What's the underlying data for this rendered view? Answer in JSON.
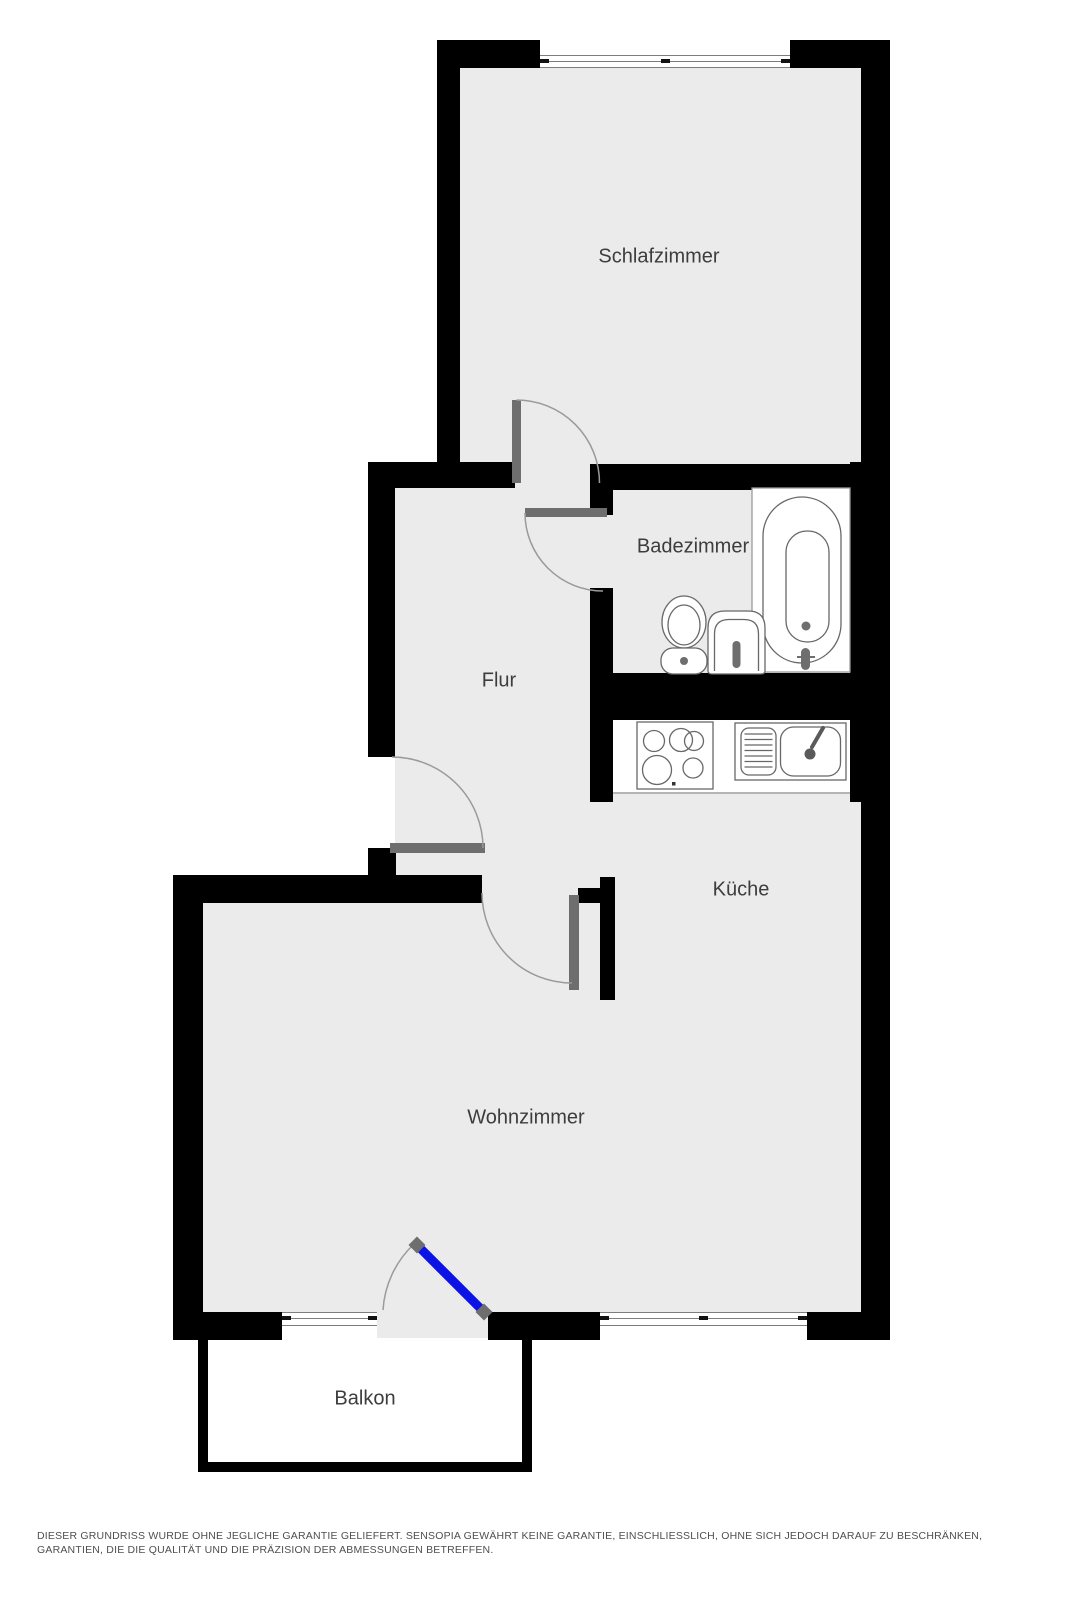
{
  "floorplan": {
    "rooms": [
      {
        "id": "schlafzimmer",
        "label": "Schlafzimmer"
      },
      {
        "id": "badezimmer",
        "label": "Badezimmer"
      },
      {
        "id": "flur",
        "label": "Flur"
      },
      {
        "id": "kueche",
        "label": "Küche"
      },
      {
        "id": "wohnzimmer",
        "label": "Wohnzimmer"
      },
      {
        "id": "balkon",
        "label": "Balkon"
      }
    ],
    "fixtures": [
      "bathtub",
      "toilet",
      "washbasin",
      "stove",
      "kitchen-sink"
    ],
    "doors": [
      "schlafzimmer-door",
      "badezimmer-door",
      "entrance-door",
      "wohnzimmer-door",
      "balcony-door"
    ],
    "windows": [
      "schlafzimmer-window",
      "wohnzimmer-window-left",
      "wohnzimmer-window-right"
    ],
    "colors": {
      "wall": "#000000",
      "floor": "#ebebeb",
      "door_leaf": "#6e6e6e",
      "balcony_door": "#0c13e6",
      "arc": "#9a9a9a",
      "fixture_stroke": "#686868",
      "label_text": "#3d3d3d",
      "disclaimer_text": "#4f4f4f"
    },
    "disclaimer": "DIESER GRUNDRISS WURDE OHNE JEGLICHE GARANTIE GELIEFERT. SENSOPIA GEWÄHRT KEINE GARANTIE, EINSCHLIESSLICH, OHNE SICH JEDOCH DARAUF ZU BESCHRÄNKEN, GARANTIEN, DIE DIE QUALITÄT UND DIE PRÄZISION DER ABMESSUNGEN BETREFFEN."
  }
}
